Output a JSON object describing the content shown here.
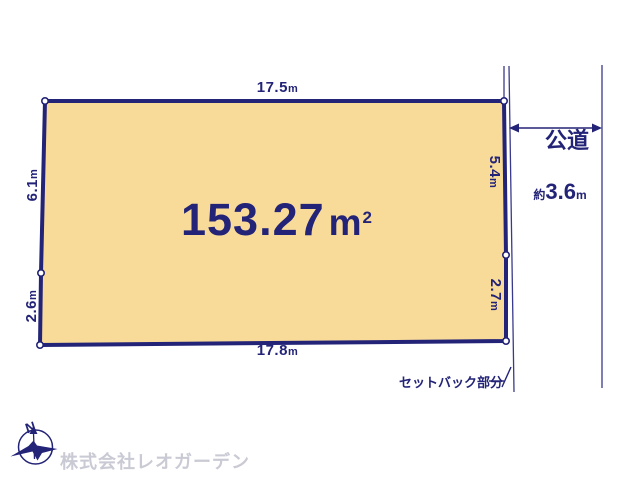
{
  "diagram": {
    "area": {
      "value": "153.27",
      "unit": "m",
      "sup": "2"
    },
    "dimensions": {
      "top": {
        "value": "17.5",
        "unit": "m"
      },
      "bottom": {
        "value": "17.8",
        "unit": "m"
      },
      "left_upper": {
        "value": "6.1",
        "unit": "m"
      },
      "left_lower": {
        "value": "2.6",
        "unit": "m"
      },
      "right_upper": {
        "value": "5.4",
        "unit": "m"
      },
      "right_lower": {
        "value": "2.7",
        "unit": "m"
      }
    },
    "road": {
      "label": "公道",
      "width_prefix": "約",
      "width_value": "3.6",
      "width_unit": "m"
    },
    "setback_label": "セットバック部分",
    "compass_label": "N"
  },
  "footer": {
    "company": "株式会社レオガーデン"
  },
  "colors": {
    "navy": "#232377",
    "plot_fill": "#F9DB99",
    "watermark_gray": "#C9CAD4",
    "background": "#FFFFFF"
  }
}
